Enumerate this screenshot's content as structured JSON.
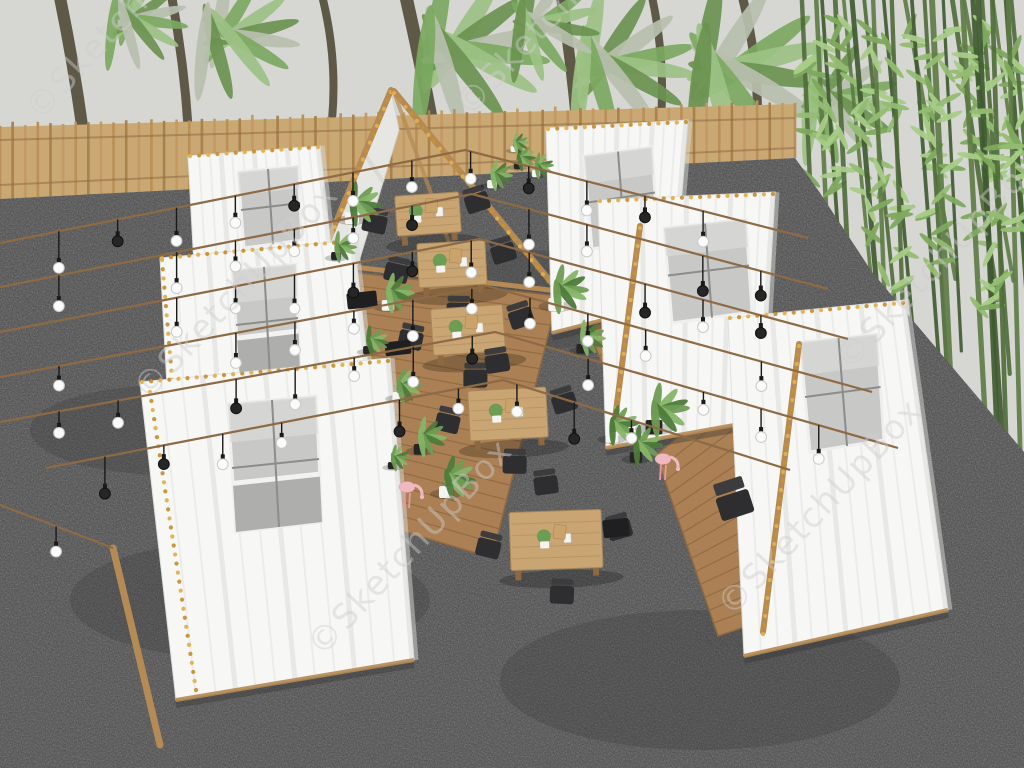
{
  "watermark": {
    "text": "©SketchUpBox"
  },
  "colors": {
    "sky": "#d6d6d3",
    "gravel": "#474747",
    "fence": "#c9a873",
    "fence_slats": [
      "#b99058",
      "#a8814c",
      "#c39a63"
    ],
    "wood": "#b58a55",
    "wood_dark": "#8d6842",
    "deck": "#ab8054",
    "tent": "#f7f7f5",
    "tent_shade": "#d8d8d6",
    "fold": "#e8e8e6",
    "window": "#c8c8c6",
    "window_dark": "#aeaeac",
    "mullion": "#8c8c8a",
    "palm_trunk": "#57523f",
    "palm_leaves": [
      "#7ca861",
      "#9cc184",
      "#6b9350",
      "#b7bfae"
    ],
    "bamboo_stalks": [
      "#4f6b39",
      "#5d7a44",
      "#3f5930"
    ],
    "bamboo_leaves": [
      "#7fa95f",
      "#93bc72",
      "#a8cc88"
    ],
    "wire": "#8d6a45",
    "bulb_white": "#fbfbfb",
    "bulb_dark": "#262626",
    "bulb_cap": "#1a1a1a",
    "bulb_golds": [
      "#e2b04a",
      "#c89031"
    ],
    "chair": "#2e2e30",
    "chair_back": "#3c3c3e",
    "table": "#c8a573",
    "table_edge": "#a8875a",
    "plant_greens": [
      "#4e7a3a",
      "#6f9c54",
      "#86b468"
    ],
    "pot_light": "#f4f4f2",
    "pot_dark": "#262626",
    "flamingo": "#f0b9bf",
    "flamingo_leg": "#e29ba3",
    "watermark_color": "#cfcfcf"
  },
  "scene": {
    "fence": {
      "x_end": 795,
      "top_y0": 127,
      "top_y1": 104,
      "bot_y0": 199,
      "bot_y1": 158,
      "slats": 64
    },
    "gravel": {
      "points": [
        [
          0,
          199
        ],
        [
          795,
          158
        ],
        [
          818,
          190
        ],
        [
          872,
          272
        ],
        [
          1024,
          452
        ],
        [
          1024,
          768
        ],
        [
          0,
          768
        ]
      ]
    },
    "gravel_patches": [
      [
        250,
        600,
        180,
        60
      ],
      [
        700,
        680,
        200,
        70
      ],
      [
        520,
        300,
        160,
        50
      ],
      [
        170,
        430,
        140,
        45
      ]
    ],
    "palms": {
      "trunks": [
        [
          98,
          292,
          58,
          -12,
          12
        ],
        [
          190,
          212,
          170,
          -12,
          9
        ],
        [
          332,
          120,
          320,
          -12,
          8
        ],
        [
          470,
          382,
          404,
          -12,
          13
        ],
        [
          585,
          300,
          560,
          -12,
          11
        ],
        [
          660,
          132,
          650,
          -12,
          8
        ],
        [
          757,
          136,
          740,
          -12,
          9
        ]
      ],
      "fronds": [
        [
          430,
          42,
          1.2
        ],
        [
          585,
          58,
          1.1
        ],
        [
          700,
          62,
          1.3
        ],
        [
          210,
          30,
          0.9
        ],
        [
          118,
          16,
          0.7
        ],
        [
          810,
          95,
          0.9
        ],
        [
          520,
          20,
          0.8
        ]
      ]
    },
    "bamboo": {
      "x0": 800,
      "count": 22,
      "extra": [
        [
          962,
          -8,
          988,
          470
        ],
        [
          978,
          -8,
          1000,
          500
        ],
        [
          992,
          -8,
          1010,
          560
        ],
        [
          1008,
          -8,
          1022,
          520
        ]
      ]
    },
    "canopy": {
      "fabric": [
        [
          391,
          90
        ],
        [
          302,
          300
        ],
        [
          346,
          304
        ],
        [
          399,
          130
        ]
      ],
      "legL": [
        [
          391,
          90
        ],
        [
          303,
          301
        ]
      ],
      "legR": [
        [
          394,
          91
        ],
        [
          583,
          321
        ]
      ],
      "inner": [
        [
          395,
          95
        ],
        [
          470,
          300
        ]
      ],
      "beam": [
        [
          320,
          263
        ],
        [
          558,
          291
        ]
      ]
    },
    "decks": [
      {
        "pts": [
          [
            316,
            268
          ],
          [
            558,
            296
          ],
          [
            492,
            558
          ],
          [
            263,
            489
          ]
        ],
        "lines": 18
      },
      {
        "pts": [
          [
            656,
            455
          ],
          [
            776,
            356
          ],
          [
            854,
            590
          ],
          [
            718,
            636
          ]
        ],
        "lines": 14
      },
      {
        "pts": [
          [
            588,
            330
          ],
          [
            654,
            292
          ],
          [
            690,
            360
          ],
          [
            618,
            400
          ]
        ],
        "lines": 8
      }
    ],
    "tents_left": [
      {
        "body": [
          [
            188,
            156
          ],
          [
            320,
            146
          ],
          [
            338,
            310
          ],
          [
            198,
            338
          ]
        ],
        "window": [
          [
            238,
            172
          ],
          [
            298,
            166
          ],
          [
            302,
            240
          ],
          [
            244,
            248
          ]
        ],
        "bed": false,
        "gold_top": [
          [
            190,
            154
          ],
          [
            318,
            145
          ]
        ],
        "gold_side": null
      },
      {
        "body": [
          [
            160,
            258
          ],
          [
            354,
            240
          ],
          [
            378,
            455
          ],
          [
            172,
            478
          ]
        ],
        "window": [
          [
            232,
            270
          ],
          [
            296,
            264
          ],
          [
            300,
            372
          ],
          [
            240,
            380
          ]
        ],
        "bed": true,
        "gold_top": [
          [
            162,
            256
          ],
          [
            352,
            239
          ]
        ],
        "gold_side": [
          [
            162,
            258
          ],
          [
            180,
            470
          ]
        ]
      },
      {
        "body": [
          [
            140,
            382
          ],
          [
            390,
            358
          ],
          [
            414,
            660
          ],
          [
            176,
            700
          ]
        ],
        "window": [
          [
            228,
            404
          ],
          [
            316,
            396
          ],
          [
            322,
            522
          ],
          [
            236,
            532
          ]
        ],
        "bed": true,
        "gold_top": [
          [
            142,
            380
          ],
          [
            388,
            359
          ]
        ],
        "gold_side": [
          [
            150,
            390
          ],
          [
            196,
            688
          ]
        ]
      }
    ],
    "tents_right": [
      {
        "body": [
          [
            546,
            128
          ],
          [
            688,
            120
          ],
          [
            673,
            302
          ],
          [
            552,
            333
          ]
        ],
        "window": [
          [
            584,
            156
          ],
          [
            652,
            147
          ],
          [
            658,
            238
          ],
          [
            592,
            249
          ]
        ],
        "bed": false,
        "gold_top": [
          [
            548,
            127
          ],
          [
            686,
            120
          ]
        ],
        "pole": null
      },
      {
        "body": [
          [
            598,
            200
          ],
          [
            775,
            192
          ],
          [
            762,
            420
          ],
          [
            606,
            448
          ]
        ],
        "window": [
          [
            664,
            228
          ],
          [
            746,
            219
          ],
          [
            752,
            312
          ],
          [
            672,
            323
          ]
        ],
        "bed": false,
        "gold_top": [
          [
            600,
            199
          ],
          [
            773,
            192
          ]
        ],
        "pole": [
          [
            640,
            226
          ],
          [
            612,
            442
          ]
        ]
      },
      {
        "body": [
          [
            728,
            318
          ],
          [
            905,
            300
          ],
          [
            948,
            610
          ],
          [
            744,
            656
          ]
        ],
        "window": [
          [
            800,
            342
          ],
          [
            877,
            334
          ],
          [
            884,
            440
          ],
          [
            810,
            452
          ]
        ],
        "bed": false,
        "gold_top": [
          [
            730,
            316
          ],
          [
            903,
            301
          ]
        ],
        "pole": [
          [
            799,
            344
          ],
          [
            763,
            632
          ]
        ]
      }
    ],
    "poles": [
      [
        113,
        548,
        160,
        745,
        7
      ]
    ],
    "wires": [
      {
        "pts": [
          [
            0,
            243
          ],
          [
            465,
            150
          ],
          [
            808,
            238
          ]
        ]
      },
      {
        "pts": [
          [
            0,
            287
          ],
          [
            472,
            194
          ],
          [
            828,
            289
          ]
        ]
      },
      {
        "pts": [
          [
            0,
            332
          ],
          [
            479,
            239
          ],
          [
            848,
            339
          ]
        ]
      },
      {
        "pts": [
          [
            0,
            377
          ],
          [
            487,
            286
          ],
          [
            872,
            392
          ]
        ]
      },
      {
        "pts": [
          [
            0,
            422
          ],
          [
            495,
            332
          ],
          [
            898,
            448
          ]
        ]
      },
      {
        "pts": [
          [
            46,
            468
          ],
          [
            503,
            380
          ],
          [
            790,
            470
          ]
        ]
      },
      {
        "pts": [
          [
            0,
            505
          ],
          [
            113,
            548
          ]
        ]
      }
    ],
    "tables": [
      {
        "x": 428,
        "y": 214,
        "w": 64,
        "h": 40,
        "rot": -4,
        "chairs": 3
      },
      {
        "x": 452,
        "y": 264,
        "w": 68,
        "h": 44,
        "rot": -3,
        "chairs": 3
      },
      {
        "x": 468,
        "y": 330,
        "w": 72,
        "h": 46,
        "rot": -4,
        "chairs": 3
      },
      {
        "x": 508,
        "y": 414,
        "w": 78,
        "h": 50,
        "rot": -3,
        "chairs": 4
      },
      {
        "x": 556,
        "y": 540,
        "w": 92,
        "h": 58,
        "rot": -2,
        "chairs": 4
      }
    ],
    "plants": [
      [
        352,
        214,
        1.0
      ],
      [
        336,
        254,
        0.7
      ],
      [
        388,
        302,
        0.9
      ],
      [
        368,
        348,
        0.7
      ],
      [
        398,
        394,
        0.8
      ],
      [
        420,
        446,
        0.9
      ],
      [
        446,
        488,
        1.0
      ],
      [
        392,
        464,
        0.6
      ],
      [
        492,
        182,
        0.7
      ],
      [
        518,
        164,
        0.6
      ],
      [
        556,
        300,
        1.1
      ],
      [
        582,
        346,
        0.8
      ],
      [
        612,
        434,
        0.9
      ],
      [
        654,
        422,
        1.2
      ],
      [
        514,
        148,
        0.5
      ],
      [
        636,
        454,
        0.9
      ],
      [
        536,
        172,
        0.6
      ]
    ],
    "boxes": [
      [
        362,
        300,
        30,
        16
      ],
      [
        398,
        348,
        26,
        14
      ],
      [
        616,
        528,
        26,
        18
      ]
    ],
    "deck_chairs": [
      [
        735,
        505,
        -18
      ]
    ],
    "flamingos": [
      [
        404,
        508
      ],
      [
        660,
        480
      ]
    ],
    "watermarks": [
      [
        40,
        122,
        -47
      ],
      [
        148,
        402,
        -47
      ],
      [
        322,
        658,
        -47
      ],
      [
        850,
        372,
        -47
      ],
      [
        732,
        618,
        -47
      ],
      [
        470,
        118,
        -47
      ]
    ]
  }
}
